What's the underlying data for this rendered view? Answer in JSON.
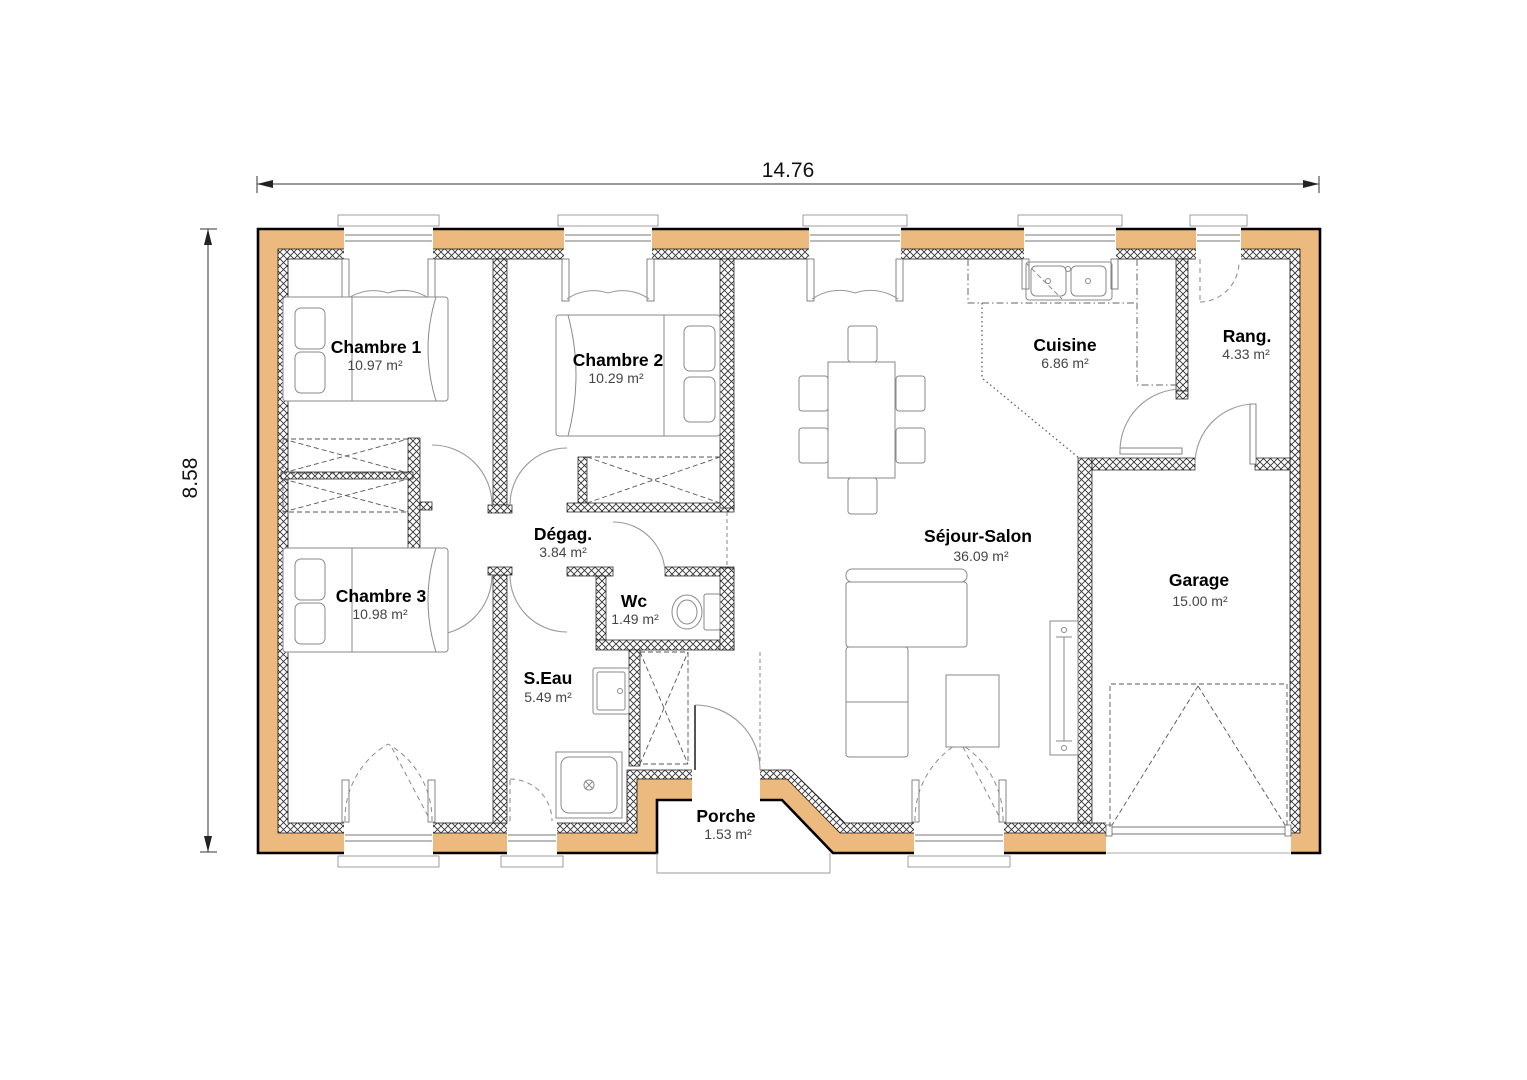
{
  "plan": {
    "title": "house-floor-plan",
    "dimension_labels": {
      "width": "14.76",
      "height": "8.58"
    },
    "rooms": [
      {
        "key": "chambre1",
        "name": "Chambre 1",
        "area": "10.97 m²"
      },
      {
        "key": "chambre2",
        "name": "Chambre 2",
        "area": "10.29 m²"
      },
      {
        "key": "chambre3",
        "name": "Chambre 3",
        "area": "10.98 m²"
      },
      {
        "key": "degagement",
        "name": "Dégag.",
        "area": "3.84 m²"
      },
      {
        "key": "wc",
        "name": "Wc",
        "area": "1.49 m²"
      },
      {
        "key": "salle-eau",
        "name": "S.Eau",
        "area": "5.49 m²"
      },
      {
        "key": "porche",
        "name": "Porche",
        "area": "1.53 m²"
      },
      {
        "key": "sejour",
        "name": "Séjour-Salon",
        "area": "36.09 m²"
      },
      {
        "key": "cuisine",
        "name": "Cuisine",
        "area": "6.86 m²"
      },
      {
        "key": "rangement",
        "name": "Rang.",
        "area": "4.33 m²"
      },
      {
        "key": "garage",
        "name": "Garage",
        "area": "15.00 m²"
      }
    ],
    "colors": {
      "exterior_wall_fill": "#ECB97E",
      "wall_outline": "#000000",
      "drawing_line": "#8a8a8a",
      "label_text": "#000000",
      "area_text": "#454545"
    },
    "symbols": [
      "double-bed",
      "wardrobe",
      "dining-table",
      "chair",
      "corner-sofa",
      "coffee-table",
      "radiator",
      "kitchen-double-sink",
      "toilet",
      "washbasin",
      "shower",
      "garage-door",
      "door-swing",
      "casement-window"
    ]
  }
}
